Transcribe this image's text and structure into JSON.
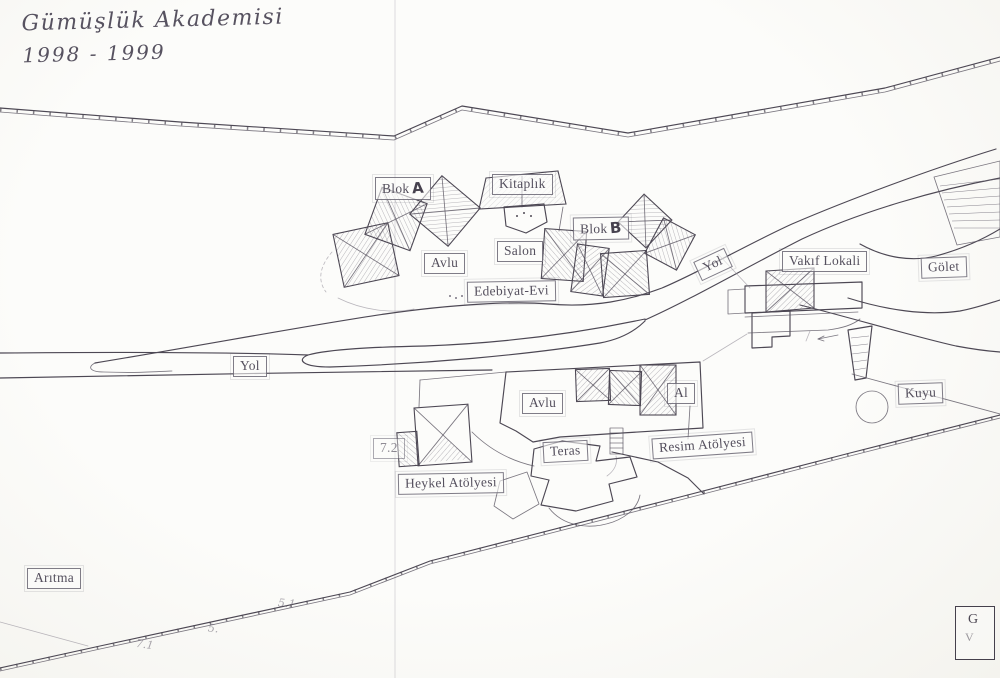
{
  "title": {
    "line1": "Gümüşlük Akademisi",
    "line2": "1998 - 1999"
  },
  "map": {
    "labels": {
      "blok_a": {
        "word": "Blok",
        "letter": "A"
      },
      "blok_b": {
        "word": "Blok",
        "letter": "B"
      },
      "kitaplik": "Kitaplık",
      "salon": "Salon",
      "avlu_upper": "Avlu",
      "edebiyat_evi": "Edebiyat-Evi",
      "yol_main": "Yol",
      "yol_left": "Yol",
      "vakif_lokali": "Vakıf Lokali",
      "golet": "Gölet",
      "avlu_lower": "Avlu",
      "al": "Al",
      "kuyu": "Kuyu",
      "resim_atolyesi": "Resim Atölyesi",
      "teras": "Teras",
      "heykel_atolyesi": "Heykel Atölyesi",
      "plot_7_2": "7.2",
      "aritma": "Arıtma"
    },
    "survey_marks": {
      "m1": "7.1",
      "m2": "5.",
      "m3": "5.1"
    },
    "stamp": {
      "line1": "G",
      "line2": "V"
    }
  },
  "colors": {
    "ink": "#4d4854",
    "paper": "#fbfbf8",
    "label_ink": "#55505e"
  }
}
